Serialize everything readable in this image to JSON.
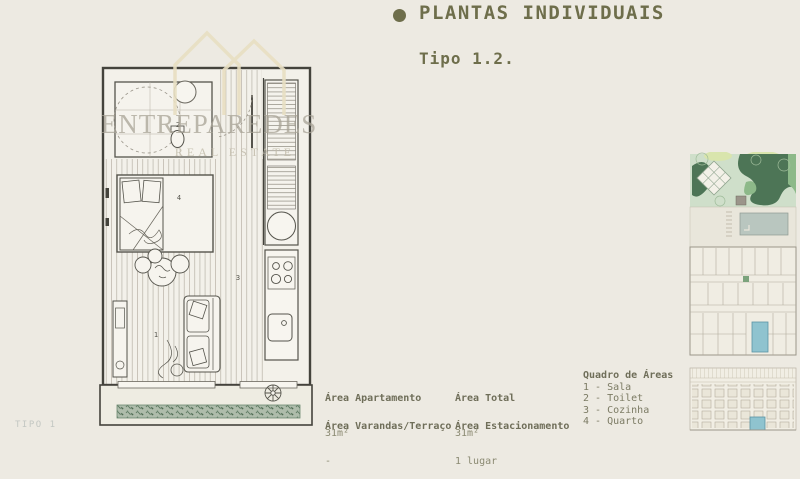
{
  "page": {
    "background": "#EDEAE2",
    "footer_label": "TIPO 1"
  },
  "header": {
    "title": "PLANTAS INDIVIDUAIS",
    "subtitle": "Tipo 1.2."
  },
  "watermark": {
    "name": "ENTREPAREDES",
    "tagline": "REAL ESTATE"
  },
  "floor_plan": {
    "rooms": {
      "sala": "1",
      "toilet": "2",
      "cozinha": "3",
      "quarto": "4"
    }
  },
  "areas": [
    {
      "label": "Área Apartamento",
      "value": "31m²"
    },
    {
      "label": "Área Total",
      "value": "31m²"
    },
    {
      "label": "Área Varandas/Terraço",
      "value": "-"
    },
    {
      "label": "Área Estacionamento",
      "value": "1 lugar"
    }
  ],
  "legend": {
    "title": "Quadro de Áreas",
    "items": [
      "1 - Sala",
      "2 - Toilet",
      "3 - Cozinha",
      "4 - Quarto"
    ]
  },
  "colors": {
    "accent_olive": "#6E6E4B",
    "body_text": "#7C7B64",
    "footer_grey": "#C3C7C2",
    "highlight_teal": "#8FC3CF",
    "garden_dark_green": "#4D7556",
    "garden_light_green": "#CFDFCA",
    "watermark_beige": "#E8DFC2",
    "plan_wall": "#44433C"
  }
}
